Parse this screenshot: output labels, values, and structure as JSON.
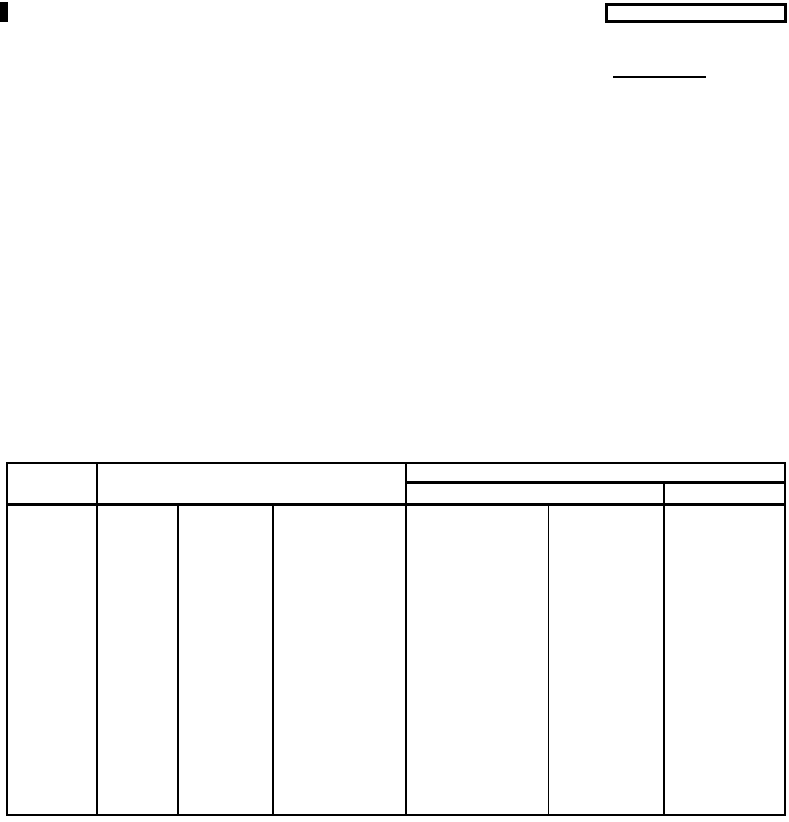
{
  "colors": {
    "background": "#ffffff",
    "ink": "#000000"
  },
  "document": {
    "corner_mark": {
      "shape": "filled-rectangle"
    },
    "top_right_box": {
      "value": ""
    },
    "fill_in_line": {
      "value": ""
    },
    "table": {
      "header": {
        "left_cell": "",
        "mid_cell": "",
        "right_span_cell": "",
        "right_sub_left_cell": "",
        "right_sub_right_cell": ""
      },
      "body_cells": [
        "",
        "",
        "",
        "",
        "",
        "",
        ""
      ]
    }
  }
}
